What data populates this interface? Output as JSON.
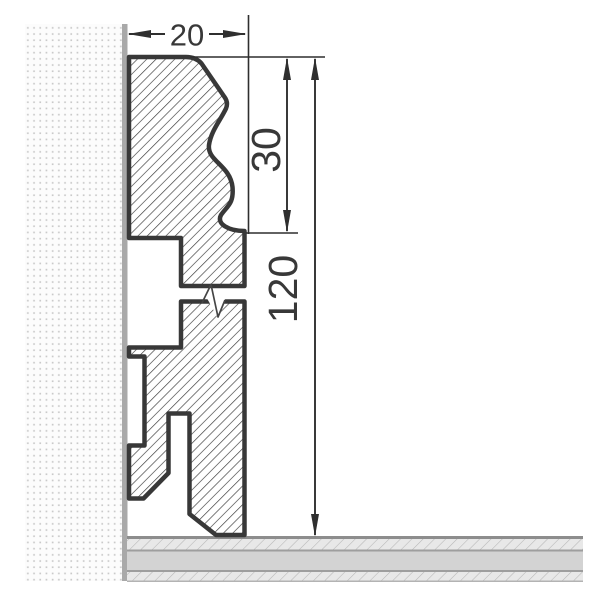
{
  "drawing": {
    "type": "technical-cross-section",
    "subject": "skirting-board-profile-mounted-on-wall-above-floor",
    "dimensions": {
      "width": {
        "value": "20",
        "orientation": "horizontal",
        "describes": "profile depth from wall"
      },
      "cap_height": {
        "value": "30",
        "orientation": "vertical",
        "describes": "decorative ogee cap height"
      },
      "total_height": {
        "value": "120",
        "orientation": "vertical",
        "describes": "total skirting height"
      }
    },
    "symbols": {
      "break_mark": "section-break-zigzag",
      "wall_texture": "stippled-dots",
      "profile_fill": "diagonal-hatch",
      "floor_fill": "layered-diagonal-hatch"
    },
    "colors": {
      "outline": "#383838",
      "hatch_line": "#3e3e3e",
      "wall_surface": "#a9a9a9",
      "wall_dot": "#cacaca",
      "wall_bg": "#fcfcfc",
      "floor_middle_band": "#d3d3d3",
      "floor_hatch_bg": "#e8e8e8",
      "floor_hatch_line": "#b6b6b6",
      "floor_edge_line": "#8d8d8d",
      "dimension_line": "#2f2f2f"
    }
  }
}
